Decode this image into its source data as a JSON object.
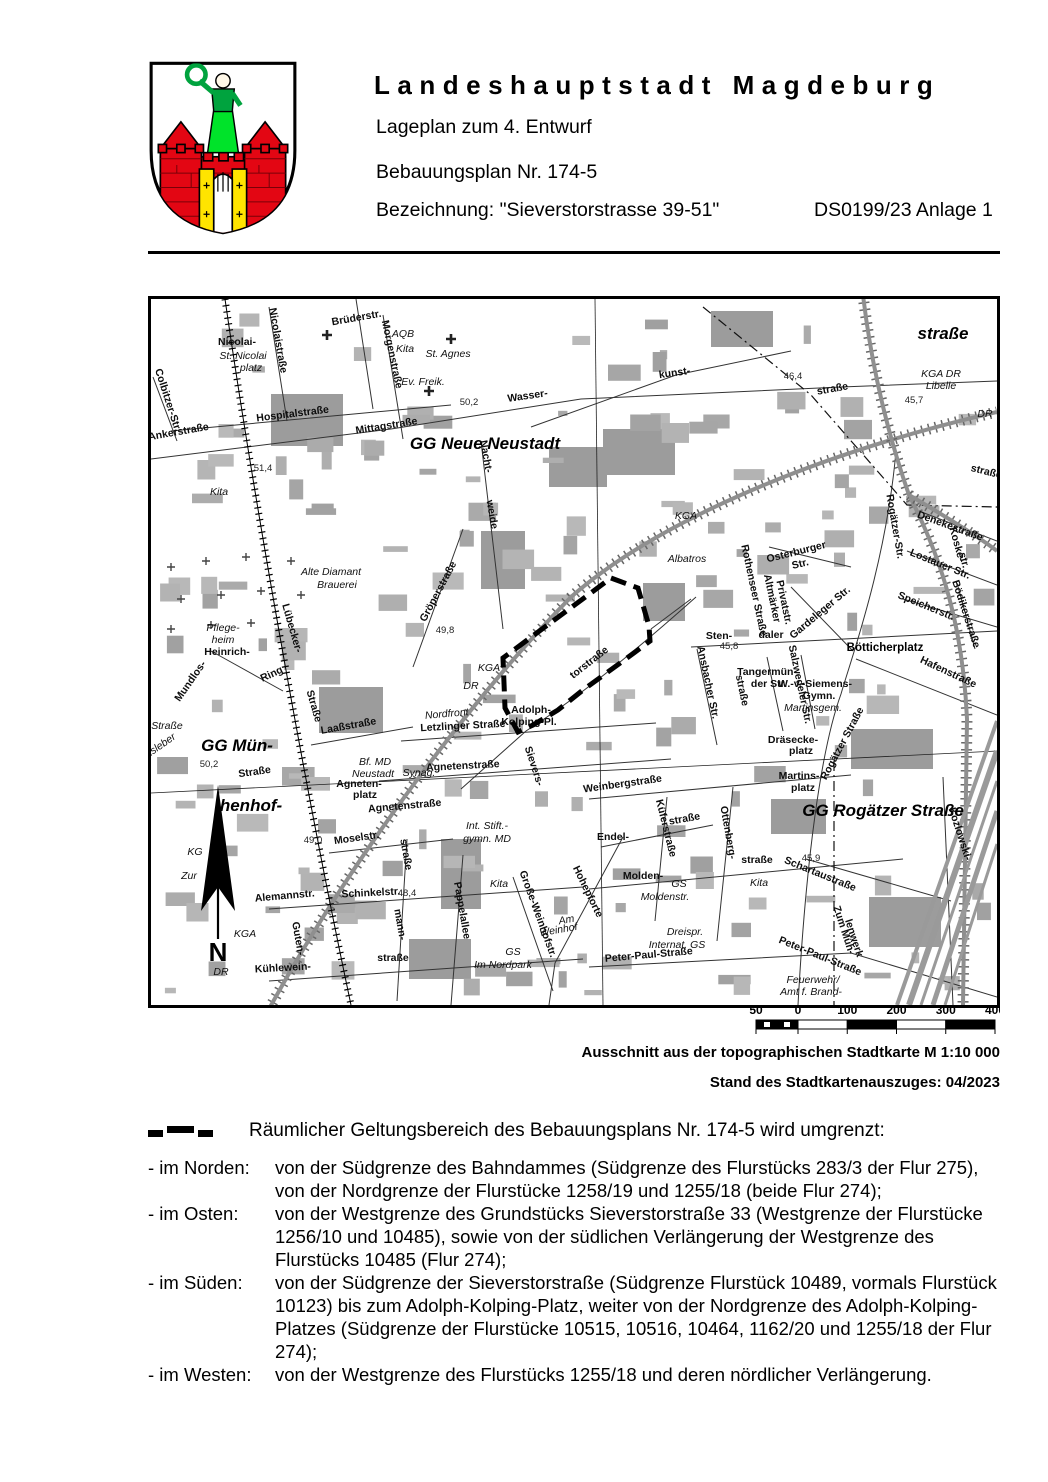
{
  "header": {
    "city_title": "Landeshauptstadt Magdeburg",
    "subtitle": "Lageplan zum 4. Entwurf",
    "plan_number": "Bebauungsplan Nr. 174-5",
    "designation": "Bezeichnung: \"Sieverstorstrasse 39-51\"",
    "doc_reference": "DS0199/23 Anlage 1"
  },
  "map": {
    "north_label": "N",
    "boundary_color": "#000000",
    "boundary_polygon_points": "460,279 487,289 498,327 499,342 472,362 432,391 407,411 382,426 367,433 354,409 352,359",
    "scale_bar": {
      "labels": [
        "50",
        "0",
        "100",
        "200",
        "300",
        "400"
      ]
    },
    "labels": [
      {
        "t": "Nicolai-",
        "x": 86,
        "y": 46
      },
      {
        "t": "St. Nicolai",
        "x": 92,
        "y": 60,
        "c": "i"
      },
      {
        "t": "platz",
        "x": 100,
        "y": 72,
        "c": "i"
      },
      {
        "t": "Nicolaistraße",
        "x": 124,
        "y": 42,
        "r": 80
      },
      {
        "t": "Brüderstr.",
        "x": 206,
        "y": 22,
        "r": -10
      },
      {
        "t": "Morgenstraße",
        "x": 238,
        "y": 56,
        "r": 78
      },
      {
        "t": "AQB",
        "x": 252,
        "y": 38,
        "c": "i"
      },
      {
        "t": "Kita",
        "x": 254,
        "y": 53,
        "c": "i"
      },
      {
        "t": "St. Agnes",
        "x": 297,
        "y": 58,
        "c": "i"
      },
      {
        "t": "Ev. Freik.",
        "x": 272,
        "y": 86,
        "c": "i"
      },
      {
        "t": "Colbitzer-Str.",
        "x": 14,
        "y": 102,
        "r": 72
      },
      {
        "t": "Ankerstraße",
        "x": 28,
        "y": 136,
        "r": -10
      },
      {
        "t": "Hospitalstraße",
        "x": 142,
        "y": 118,
        "r": -7
      },
      {
        "t": "Mittagstraße",
        "x": 236,
        "y": 130,
        "r": -9
      },
      {
        "t": "GG Neue Neustadt",
        "x": 334,
        "y": 150,
        "c": "g"
      },
      {
        "t": "50,2",
        "x": 318,
        "y": 106,
        "c": "e"
      },
      {
        "t": "Wasser-",
        "x": 377,
        "y": 100,
        "r": -8
      },
      {
        "t": "Nacht-",
        "x": 332,
        "y": 158,
        "r": 80
      },
      {
        "t": "weide",
        "x": 338,
        "y": 216,
        "r": 80
      },
      {
        "t": "51,4",
        "x": 112,
        "y": 172,
        "c": "e"
      },
      {
        "t": "Kita",
        "x": 68,
        "y": 196,
        "c": "i"
      },
      {
        "t": "kunst-",
        "x": 524,
        "y": 77,
        "r": -8
      },
      {
        "t": "46,4",
        "x": 642,
        "y": 80,
        "c": "e"
      },
      {
        "t": "straße",
        "x": 682,
        "y": 93,
        "r": -10
      },
      {
        "t": "straße",
        "x": 792,
        "y": 40,
        "c": "g"
      },
      {
        "t": "KGA DR",
        "x": 790,
        "y": 78,
        "c": "i"
      },
      {
        "t": "Libelle",
        "x": 790,
        "y": 90,
        "c": "i"
      },
      {
        "t": "45,7",
        "x": 763,
        "y": 104,
        "c": "e"
      },
      {
        "t": "DR",
        "x": 834,
        "y": 118,
        "c": "i"
      },
      {
        "t": "straße.",
        "x": 836,
        "y": 176,
        "r": 14
      },
      {
        "t": "Denekestraße",
        "x": 798,
        "y": 230,
        "r": 20
      },
      {
        "t": "KGA",
        "x": 535,
        "y": 220,
        "c": "i"
      },
      {
        "t": "Albatros",
        "x": 536,
        "y": 263,
        "c": "i"
      },
      {
        "t": "Osterburger",
        "x": 646,
        "y": 256,
        "r": -14
      },
      {
        "t": "Str.",
        "x": 650,
        "y": 268,
        "r": -14
      },
      {
        "t": "Rothenseer Straße",
        "x": 600,
        "y": 292,
        "r": 78
      },
      {
        "t": "Altmärker",
        "x": 618,
        "y": 300,
        "r": 78
      },
      {
        "t": "Privatstr.",
        "x": 630,
        "y": 304,
        "r": 78
      },
      {
        "t": "Koske-",
        "x": 803,
        "y": 246,
        "r": 75
      },
      {
        "t": "str.",
        "x": 810,
        "y": 262,
        "r": 75
      },
      {
        "t": "Lostauer Str.",
        "x": 788,
        "y": 268,
        "r": 22
      },
      {
        "t": "Speicherstr.",
        "x": 774,
        "y": 310,
        "r": 22
      },
      {
        "t": "Bödikerstraße",
        "x": 812,
        "y": 316,
        "r": 72
      },
      {
        "t": "Rogätzer-Str.",
        "x": 741,
        "y": 228,
        "r": 80
      },
      {
        "t": "Gardeleger Str.",
        "x": 671,
        "y": 316,
        "r": -40
      },
      {
        "t": "Bötticherplatz",
        "x": 734,
        "y": 352,
        "c": "p"
      },
      {
        "t": "Hafenstraße",
        "x": 796,
        "y": 376,
        "r": 25
      },
      {
        "t": "Sten-",
        "x": 568,
        "y": 340
      },
      {
        "t": "45,8",
        "x": 578,
        "y": 350,
        "c": "e"
      },
      {
        "t": "daler",
        "x": 620,
        "y": 339
      },
      {
        "t": "Ansbacher Str.",
        "x": 554,
        "y": 384,
        "r": 78
      },
      {
        "t": "straße",
        "x": 588,
        "y": 392,
        "r": 78
      },
      {
        "t": "Tangermün-",
        "x": 616,
        "y": 376
      },
      {
        "t": "der Str.",
        "x": 618,
        "y": 388
      },
      {
        "t": "Salzwedeler Str.",
        "x": 646,
        "y": 386,
        "r": 78
      },
      {
        "t": "W.-v.-Siemens-",
        "x": 664,
        "y": 388
      },
      {
        "t": "Gymn.",
        "x": 668,
        "y": 400
      },
      {
        "t": "Martinsgem.",
        "x": 662,
        "y": 412,
        "c": "i"
      },
      {
        "t": "Dräsecke-",
        "x": 642,
        "y": 444
      },
      {
        "t": "platz",
        "x": 650,
        "y": 455
      },
      {
        "t": "Martins-",
        "x": 648,
        "y": 480
      },
      {
        "t": "platz",
        "x": 652,
        "y": 492
      },
      {
        "t": "Rogätzer Straße",
        "x": 694,
        "y": 446,
        "r": -62
      },
      {
        "t": "GG Rogätzer Straße",
        "x": 732,
        "y": 517,
        "c": "g"
      },
      {
        "t": "45,9",
        "x": 660,
        "y": 562,
        "c": "e"
      },
      {
        "t": "Schartaustraße",
        "x": 668,
        "y": 578,
        "r": 22
      },
      {
        "t": "Kozlowski-",
        "x": 806,
        "y": 536,
        "r": 72
      },
      {
        "t": "torstraße",
        "x": 440,
        "y": 366,
        "r": -38
      },
      {
        "t": "Sievers-",
        "x": 380,
        "y": 468,
        "r": 72
      },
      {
        "t": "Hohepforte",
        "x": 434,
        "y": 594,
        "r": 64
      },
      {
        "t": "Adolph-",
        "x": 380,
        "y": 414
      },
      {
        "t": "Kolping-Pl.",
        "x": 378,
        "y": 426
      },
      {
        "t": "Nordfront",
        "x": 296,
        "y": 418,
        "c": "i",
        "r": -5
      },
      {
        "t": "Letzlinger Straße",
        "x": 312,
        "y": 430,
        "r": -3
      },
      {
        "t": "Laaßstraße",
        "x": 198,
        "y": 430,
        "r": -10
      },
      {
        "t": "Lübecker-",
        "x": 138,
        "y": 330,
        "r": 74
      },
      {
        "t": "Straße",
        "x": 160,
        "y": 408,
        "r": 74
      },
      {
        "t": "Gröperstraße",
        "x": 290,
        "y": 294,
        "r": -62
      },
      {
        "t": "49,8",
        "x": 294,
        "y": 334,
        "c": "e"
      },
      {
        "t": "Alte Diamant",
        "x": 180,
        "y": 276,
        "c": "i"
      },
      {
        "t": "Brauerei",
        "x": 186,
        "y": 289,
        "c": "i"
      },
      {
        "t": "Pflege-",
        "x": 72,
        "y": 332,
        "c": "i"
      },
      {
        "t": "heim",
        "x": 72,
        "y": 344,
        "c": "i"
      },
      {
        "t": "Heinrich-",
        "x": 76,
        "y": 356
      },
      {
        "t": "Mundlos-",
        "x": 42,
        "y": 384,
        "r": -55
      },
      {
        "t": "Ring",
        "x": 122,
        "y": 378,
        "r": -25
      },
      {
        "t": "Straße",
        "x": 16,
        "y": 430,
        "c": "i"
      },
      {
        "t": "Insleber",
        "x": 10,
        "y": 450,
        "r": -35,
        "c": "i"
      },
      {
        "t": "GG Mün-",
        "x": 86,
        "y": 452,
        "c": "g"
      },
      {
        "t": "50,2",
        "x": 58,
        "y": 468,
        "c": "e"
      },
      {
        "t": "Straße",
        "x": 104,
        "y": 476,
        "r": -8
      },
      {
        "t": "henhof-",
        "x": 100,
        "y": 512,
        "c": "g"
      },
      {
        "t": "KG",
        "x": 44,
        "y": 556,
        "c": "i"
      },
      {
        "t": "Zur",
        "x": 38,
        "y": 580,
        "c": "i"
      },
      {
        "t": "KGA",
        "x": 94,
        "y": 638,
        "c": "i"
      },
      {
        "t": "KGA",
        "x": 338,
        "y": 372,
        "c": "i"
      },
      {
        "t": "DR",
        "x": 320,
        "y": 390,
        "c": "i"
      },
      {
        "t": "Bf. MD",
        "x": 224,
        "y": 466,
        "c": "i"
      },
      {
        "t": "Neustadt",
        "x": 222,
        "y": 478,
        "c": "i"
      },
      {
        "t": "Synag.",
        "x": 268,
        "y": 477,
        "c": "i"
      },
      {
        "t": "Agneten-",
        "x": 208,
        "y": 488
      },
      {
        "t": "platz",
        "x": 214,
        "y": 499
      },
      {
        "t": "Agnetenstraße",
        "x": 312,
        "y": 470,
        "r": -3
      },
      {
        "t": "Agnetenstraße",
        "x": 254,
        "y": 510,
        "r": -5
      },
      {
        "t": "49,0",
        "x": 162,
        "y": 544,
        "c": "e"
      },
      {
        "t": "Moselstr.",
        "x": 206,
        "y": 542,
        "r": -8
      },
      {
        "t": "straße",
        "x": 252,
        "y": 556,
        "r": 80
      },
      {
        "t": "mann-",
        "x": 246,
        "y": 626,
        "r": 80
      },
      {
        "t": "Alemannstr.",
        "x": 134,
        "y": 600,
        "r": -5
      },
      {
        "t": "Schinkelstr.",
        "x": 220,
        "y": 597,
        "r": -3
      },
      {
        "t": "48,4",
        "x": 256,
        "y": 597,
        "c": "e"
      },
      {
        "t": "Guten-",
        "x": 144,
        "y": 640,
        "r": 80
      },
      {
        "t": "Kühlewein-",
        "x": 132,
        "y": 672,
        "r": -3
      },
      {
        "t": "straße",
        "x": 242,
        "y": 662
      },
      {
        "t": "Pappelallee",
        "x": 308,
        "y": 612,
        "r": 80
      },
      {
        "t": "Int. Stift.-",
        "x": 336,
        "y": 530,
        "c": "i"
      },
      {
        "t": "gymn. MD",
        "x": 336,
        "y": 543,
        "c": "i"
      },
      {
        "t": "Kita",
        "x": 348,
        "y": 588,
        "c": "i"
      },
      {
        "t": "Große-Weinhofstr.",
        "x": 384,
        "y": 616,
        "r": 70
      },
      {
        "t": "Am",
        "x": 416,
        "y": 624,
        "r": -10,
        "c": "i"
      },
      {
        "t": "Weinhof",
        "x": 408,
        "y": 634,
        "r": -10,
        "c": "i"
      },
      {
        "t": "GS",
        "x": 362,
        "y": 656,
        "c": "i"
      },
      {
        "t": "Im Nordpark",
        "x": 352,
        "y": 669,
        "c": "i"
      },
      {
        "t": "Weinbergstraße",
        "x": 472,
        "y": 488,
        "r": -8
      },
      {
        "t": "Endel-",
        "x": 462,
        "y": 541
      },
      {
        "t": "Küferstraße",
        "x": 512,
        "y": 530,
        "r": 76
      },
      {
        "t": "straße",
        "x": 534,
        "y": 523,
        "r": -10
      },
      {
        "t": "Ottenberg-",
        "x": 574,
        "y": 534,
        "r": 80
      },
      {
        "t": "Molden-",
        "x": 492,
        "y": 580
      },
      {
        "t": "GS",
        "x": 528,
        "y": 588,
        "c": "i"
      },
      {
        "t": "Moldenstr.",
        "x": 514,
        "y": 601,
        "c": "i"
      },
      {
        "t": "straße",
        "x": 606,
        "y": 564
      },
      {
        "t": "Kita",
        "x": 608,
        "y": 587,
        "c": "i"
      },
      {
        "t": "Dreispr.",
        "x": 534,
        "y": 636,
        "c": "i"
      },
      {
        "t": "Internat. GS",
        "x": 526,
        "y": 649,
        "c": "i"
      },
      {
        "t": "Peter-Paul-Straße",
        "x": 498,
        "y": 659,
        "r": -5
      },
      {
        "t": "Peter-Paul-Straße",
        "x": 668,
        "y": 660,
        "r": 22
      },
      {
        "t": "Zum Müh-",
        "x": 690,
        "y": 632,
        "r": 72
      },
      {
        "t": "lenwerk",
        "x": 700,
        "y": 640,
        "r": 72
      },
      {
        "t": "Feuerwehr/",
        "x": 662,
        "y": 684,
        "c": "i"
      },
      {
        "t": "Amt f. Brand-",
        "x": 660,
        "y": 696,
        "c": "i"
      },
      {
        "t": "DR",
        "x": 70,
        "y": 676,
        "c": "i"
      },
      {
        "t": "N",
        "x": 67,
        "y": 662,
        "c": "N"
      }
    ]
  },
  "captions": {
    "source": "Ausschnitt aus der topographischen Stadtkarte M 1:10 000",
    "date": "Stand des Stadtkartenauszuges: 04/2023"
  },
  "legend": {
    "text": "Räumlicher Geltungsbereich des Bebauungsplans Nr. 174-5 wird umgrenzt:"
  },
  "boundaries": [
    {
      "label": "- im Norden:",
      "text": "von der Südgrenze des Bahndammes (Südgrenze des Flurstücks 283/3 der Flur 275), von der Nordgrenze der Flurstücke 1258/19 und 1255/18 (beide Flur 274);"
    },
    {
      "label": "- im Osten:",
      "text": "von der Westgrenze des Grundstücks Sieverstorstraße 33 (Westgrenze der Flurstücke 1256/10 und 10485), sowie von der südlichen Verlängerung der Westgrenze des Flurstücks 10485 (Flur 274);"
    },
    {
      "label": "- im Süden:",
      "text": "von der Südgrenze der Sieverstorstraße (Südgrenze Flurstück 10489, vormals Flurstück 10123) bis zum Adolph-Kolping-Platz, weiter von der Nordgrenze des Adolph-Kolping-Platzes (Südgrenze der Flurstücke 10515, 10516, 10464, 1162/20 und 1255/18 der Flur 274);"
    },
    {
      "label": "- im Westen:",
      "text": "von der Westgrenze des Flurstücks 1255/18 und deren nördlicher Verlängerung."
    }
  ],
  "colors": {
    "crest_red": "#e30613",
    "crest_green": "#00a33e",
    "crest_yellow": "#ffe400",
    "building_gray": "#a9a9a9",
    "boundary_black": "#000000"
  }
}
